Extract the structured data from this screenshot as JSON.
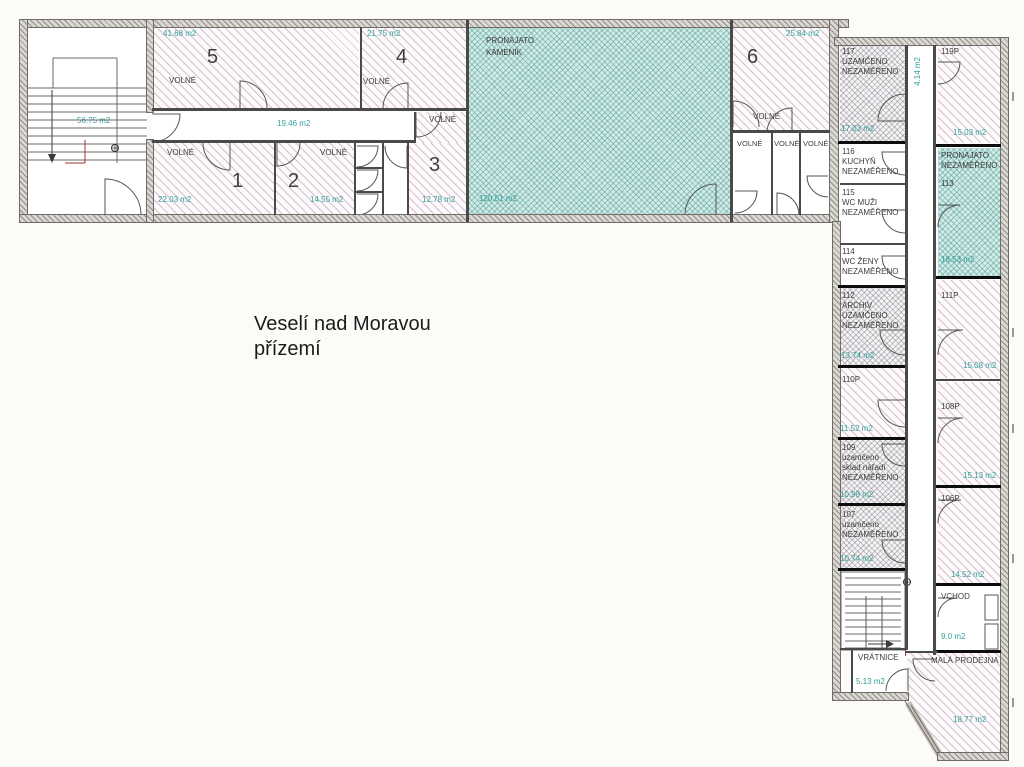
{
  "title": {
    "line1": "Veselí nad Moravou",
    "line2": "přízemí"
  },
  "colors": {
    "area_text": "#2f9f99",
    "pink_hatch": "#b782a3",
    "teal_fill": "#d3eae7",
    "gray_hatch": "#78737d",
    "wall": "#6f6c68"
  },
  "plan": {
    "west_wing": {
      "stairwell": {
        "area": "56.75 m2"
      },
      "room5": {
        "number": "5",
        "status": "VOLNÉ",
        "area": "41.68 m2"
      },
      "room4": {
        "number": "4",
        "status": "VOLNÉ",
        "area": "21.75 m2"
      },
      "corridor": {
        "area": "19.46 m2"
      },
      "room1": {
        "number": "1",
        "status": "VOLNÉ",
        "area": "22.03 m2"
      },
      "room2": {
        "number": "2",
        "status": "VOLNÉ",
        "area": "14.55 m2"
      },
      "room3": {
        "number": "3",
        "status": "VOLNÉ",
        "area": "12.78 m2"
      },
      "kamenik": {
        "tenant_line1": "PRONAJATO",
        "tenant_line2": "KAMENÍK",
        "area": "120.51 m2"
      },
      "room6": {
        "number": "6",
        "status": "VOLNÉ",
        "area": "25.84 m2"
      },
      "small_room_a": {
        "status": "VOLNÉ"
      },
      "small_room_b": {
        "status": "VOLNÉ"
      },
      "small_room_c": {
        "status": "VOLNÉ"
      }
    },
    "east_wing": {
      "corridor": {
        "area": "4.14 m2"
      },
      "room117": {
        "number": "117",
        "line1": "UZAMČENO",
        "line2": "NEZAMĚŘENO",
        "area": "17.03 m2"
      },
      "room119p": {
        "number": "119P",
        "area": "15.03 m2"
      },
      "room116": {
        "number": "116",
        "line1": "KUCHYŇ",
        "line2": "NEZAMĚŘENO"
      },
      "room115": {
        "number": "115",
        "line1": "WC MUŽI",
        "line2": "NEZAMĚŘENO"
      },
      "room114": {
        "number": "114",
        "line1": "WC ŽENY",
        "line2": "NEZAMĚŘENO"
      },
      "room113": {
        "line1": "PRONAJATO",
        "line2": "NEZAMĚŘENO",
        "number": "113",
        "area": "18.53 m2"
      },
      "room112": {
        "number": "112",
        "line1": "ARCHIV",
        "line2": "UZAMČENO",
        "line3": "NEZAMĚŘENO",
        "area": "13.74 m2"
      },
      "room111p": {
        "number": "111P",
        "area": "15.08 m2"
      },
      "room110p": {
        "number": "110P",
        "area": "11.52 m2"
      },
      "room109": {
        "number": "109",
        "line1": "uzamčeno",
        "line2": "sklad nářadí",
        "line3": "NEZAMĚŘENO",
        "area": "10.98 m2"
      },
      "room108p": {
        "number": "108P",
        "area": "15.13 m2"
      },
      "room107": {
        "number": "107",
        "line1": "uzamčeno",
        "line2": "NEZAMĚŘENO",
        "area": "10.74 m2"
      },
      "room106p": {
        "number": "106P",
        "area": "14.52 m2"
      },
      "vchod": {
        "name": "VCHOD",
        "area": "9.0 m2"
      },
      "vratnice": {
        "name": "VRÁTNICE",
        "area": "5.13 m2"
      },
      "prodejna": {
        "name": "MALÁ PRODEJNA",
        "area": "18.77 m2"
      }
    }
  }
}
